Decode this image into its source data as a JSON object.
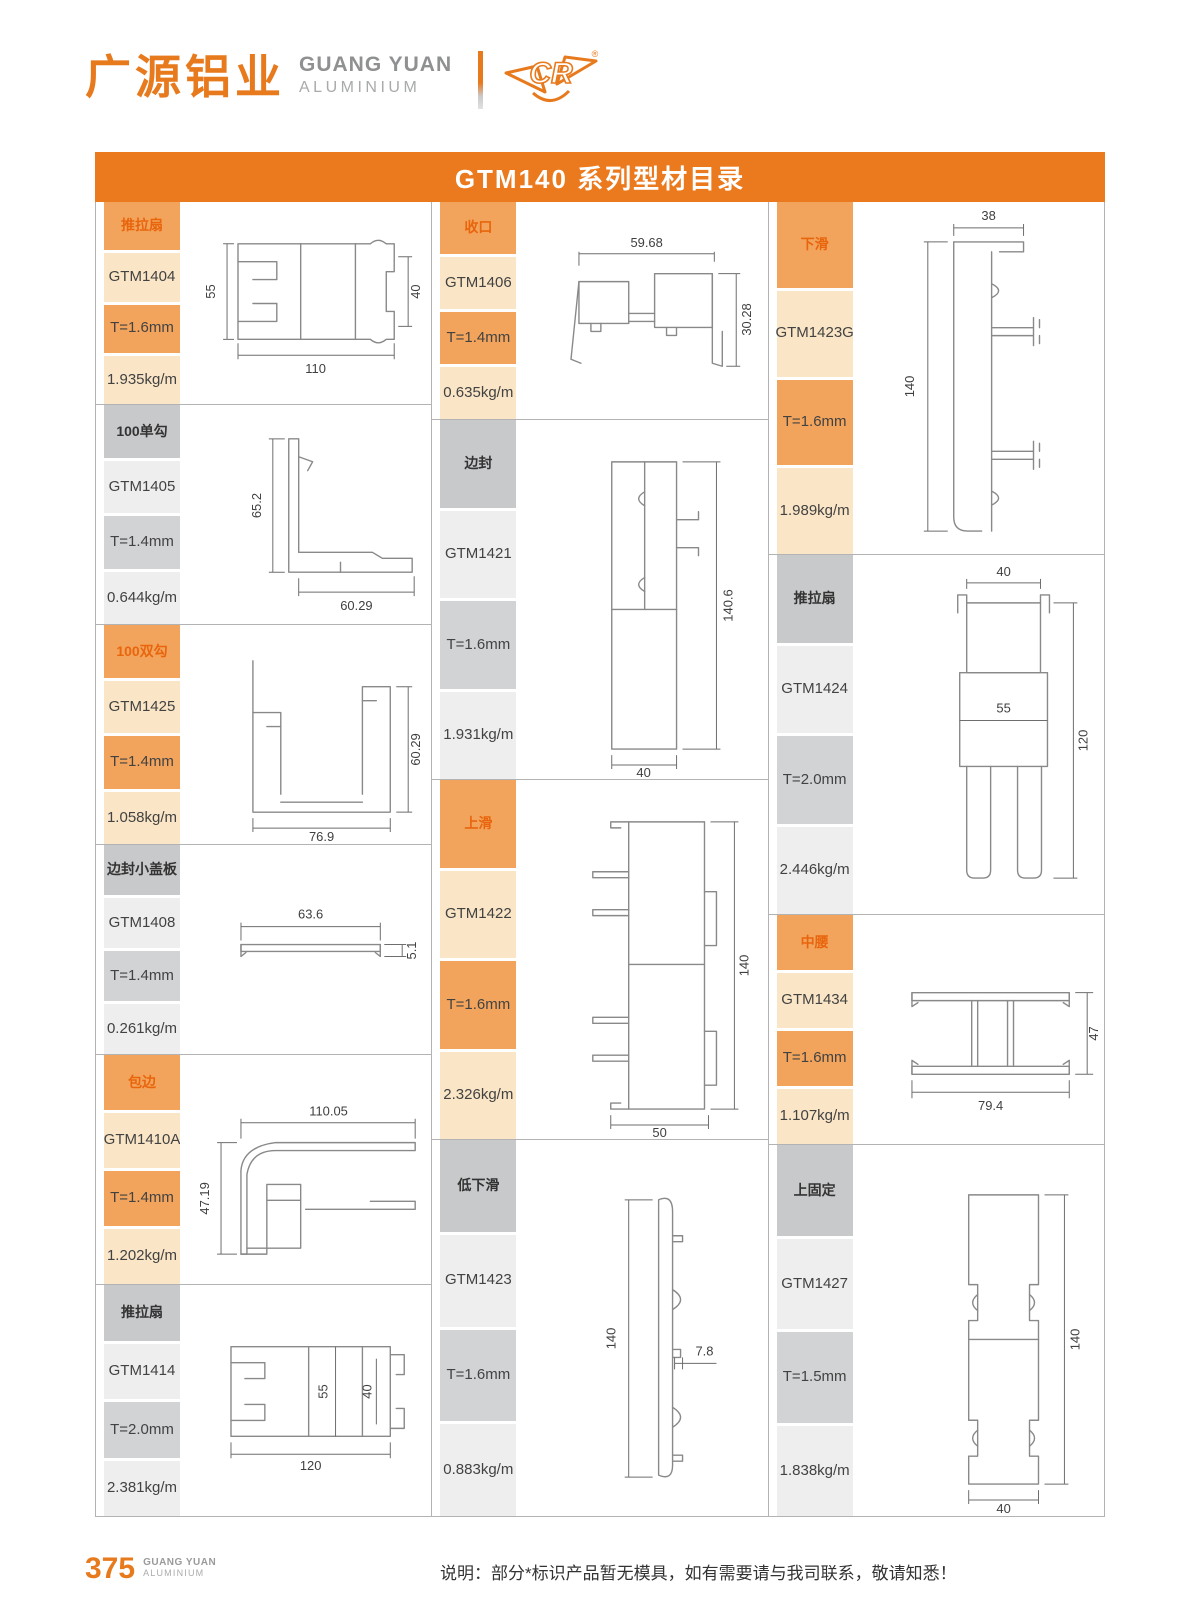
{
  "brand": {
    "logo_cn": "广源铝业",
    "logo_en_line1": "GUANG YUAN",
    "logo_en_line2": "ALUMINIUM",
    "logo_mark": "CR",
    "registered": "®"
  },
  "title": "GTM140 系列型材目录",
  "colors": {
    "accent_orange": "#EB7A1E",
    "label_orange": "#F2A45C",
    "label_orange_light": "#FAE6C6",
    "label_gray": "#C8C9CB",
    "label_gray_light": "#EEEEEF"
  },
  "columns": [
    {
      "entries": [
        {
          "category": "推拉扇",
          "code": "GTM1404",
          "thickness": "T=1.6mm",
          "weight": "1.935kg/m",
          "dims": {
            "a": "55",
            "b": "110",
            "c": "40"
          }
        },
        {
          "category": "100单勾",
          "code": "GTM1405",
          "thickness": "T=1.4mm",
          "weight": "0.644kg/m",
          "dims": {
            "a": "65.2",
            "b": "60.29"
          }
        },
        {
          "category": "100双勾",
          "code": "GTM1425",
          "thickness": "T=1.4mm",
          "weight": "1.058kg/m",
          "dims": {
            "a": "76.9",
            "b": "60.29"
          }
        },
        {
          "category": "边封小盖板",
          "code": "GTM1408",
          "thickness": "T=1.4mm",
          "weight": "0.261kg/m",
          "dims": {
            "a": "63.6",
            "b": "5.1"
          }
        },
        {
          "category": "包边",
          "code": "GTM1410A",
          "thickness": "T=1.4mm",
          "weight": "1.202kg/m",
          "dims": {
            "a": "110.05",
            "b": "47.19"
          }
        },
        {
          "category": "推拉扇",
          "code": "GTM1414",
          "thickness": "T=2.0mm",
          "weight": "2.381kg/m",
          "dims": {
            "a": "55",
            "b": "40",
            "c": "120"
          }
        }
      ]
    },
    {
      "entries": [
        {
          "category": "收口",
          "code": "GTM1406",
          "thickness": "T=1.4mm",
          "weight": "0.635kg/m",
          "dims": {
            "a": "59.68",
            "b": "30.28"
          }
        },
        {
          "category": "边封",
          "code": "GTM1421",
          "thickness": "T=1.6mm",
          "weight": "1.931kg/m",
          "dims": {
            "a": "140.6",
            "b": "40"
          }
        },
        {
          "category": "上滑",
          "code": "GTM1422",
          "thickness": "T=1.6mm",
          "weight": "2.326kg/m",
          "dims": {
            "a": "140",
            "b": "50"
          }
        },
        {
          "category": "低下滑",
          "code": "GTM1423",
          "thickness": "T=1.6mm",
          "weight": "0.883kg/m",
          "dims": {
            "a": "140",
            "b": "7.8"
          }
        }
      ]
    },
    {
      "entries": [
        {
          "category": "下滑",
          "code": "GTM1423G",
          "thickness": "T=1.6mm",
          "weight": "1.989kg/m",
          "dims": {
            "a": "38",
            "b": "140"
          }
        },
        {
          "category": "推拉扇",
          "code": "GTM1424",
          "thickness": "T=2.0mm",
          "weight": "2.446kg/m",
          "dims": {
            "a": "40",
            "b": "55",
            "c": "120"
          }
        },
        {
          "category": "中腰",
          "code": "GTM1434",
          "thickness": "T=1.6mm",
          "weight": "1.107kg/m",
          "dims": {
            "a": "79.4",
            "b": "47"
          }
        },
        {
          "category": "上固定",
          "code": "GTM1427",
          "thickness": "T=1.5mm",
          "weight": "1.838kg/m",
          "dims": {
            "a": "140",
            "b": "40"
          }
        }
      ]
    }
  ],
  "footer": {
    "page_number": "375",
    "brand_line1": "GUANG YUAN",
    "brand_line2": "ALUMINIUM",
    "note": "说明：部分*标识产品暂无模具，如有需要请与我司联系，敬请知悉！"
  }
}
